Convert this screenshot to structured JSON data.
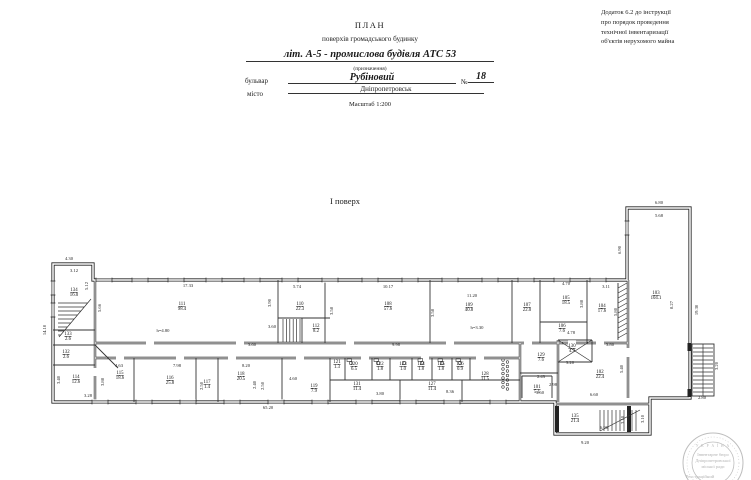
{
  "page": {
    "appendix_note_lines": [
      "Додаток 6.2 до інструкції",
      "про порядок проведення",
      "технічної інвентаризації",
      "об'єктів нерухомого майна"
    ],
    "title": "ПЛАН",
    "subtitle": "поверхів громадського будинку",
    "designation_value": "літ. А-5 - промислова будівля АТС 53",
    "designation_caption": "(призначення)",
    "street_label": "бульвар",
    "street_value": "Рубіновий",
    "number_label": "№",
    "number_value": "18",
    "city_label": "місто",
    "city_value": "Дніпропетровськ",
    "scale_label": "Масштаб 1:200",
    "floor_label": "І поверх"
  },
  "stamp": {
    "arc_text": "У К Р А Ї Н А",
    "lines": [
      "Інвентарне бюро",
      "Дніпропетровської",
      "міської ради"
    ],
    "footer": "Реєстраційний"
  },
  "plan": {
    "rooms": [
      {
        "id": "134",
        "area": "16.0",
        "x": 74,
        "y": 291
      },
      {
        "id": "133",
        "area": "2.6",
        "x": 68,
        "y": 335
      },
      {
        "id": "132",
        "area": "2.6",
        "x": 66,
        "y": 353
      },
      {
        "id": "114",
        "area": "12.6",
        "x": 76,
        "y": 378
      },
      {
        "id": "111",
        "area": "98.4",
        "x": 182,
        "y": 305
      },
      {
        "id": "115",
        "area": "18.6",
        "x": 120,
        "y": 374
      },
      {
        "id": "116",
        "area": "25.8",
        "x": 170,
        "y": 379
      },
      {
        "id": "117",
        "area": "1.4",
        "x": 207,
        "y": 383
      },
      {
        "id": "118",
        "area": "20.5",
        "x": 241,
        "y": 375
      },
      {
        "id": "119",
        "area": "7.9",
        "x": 314,
        "y": 387
      },
      {
        "id": "110",
        "area": "22.3",
        "x": 300,
        "y": 305
      },
      {
        "id": "112",
        "area": "8.2",
        "x": 316,
        "y": 327
      },
      {
        "id": "108",
        "area": "57.6",
        "x": 388,
        "y": 305
      },
      {
        "id": "109",
        "area": "40.8",
        "x": 469,
        "y": 306
      },
      {
        "id": "107",
        "area": "22.0",
        "x": 527,
        "y": 306
      },
      {
        "id": "105",
        "area": "18.5",
        "x": 566,
        "y": 299
      },
      {
        "id": "104",
        "area": "17.6",
        "x": 602,
        "y": 307
      },
      {
        "id": "106",
        "area": "7.6",
        "x": 562,
        "y": 327
      },
      {
        "id": "103",
        "area": "104.1",
        "x": 656,
        "y": 294
      },
      {
        "id": "121",
        "area": "1.3",
        "x": 337,
        "y": 363
      },
      {
        "id": "120",
        "area": "6.5",
        "x": 354,
        "y": 365
      },
      {
        "id": "122",
        "area": "1.8",
        "x": 380,
        "y": 365
      },
      {
        "id": "123",
        "area": "1.0",
        "x": 403,
        "y": 365
      },
      {
        "id": "124",
        "area": "1.8",
        "x": 421,
        "y": 365
      },
      {
        "id": "125",
        "area": "1.8",
        "x": 441,
        "y": 365
      },
      {
        "id": "126",
        "area": "0.9",
        "x": 460,
        "y": 365
      },
      {
        "id": "131",
        "area": "11.4",
        "x": 357,
        "y": 385
      },
      {
        "id": "127",
        "area": "11.4",
        "x": 432,
        "y": 385
      },
      {
        "id": "128",
        "area": "11.5",
        "x": 485,
        "y": 375
      },
      {
        "id": "129",
        "area": "7.6",
        "x": 541,
        "y": 356
      },
      {
        "id": "130",
        "area": "4.9",
        "x": 572,
        "y": 347
      },
      {
        "id": "102",
        "area": "22.4",
        "x": 600,
        "y": 373
      },
      {
        "id": "101",
        "area": "5.1",
        "x": 537,
        "y": 388
      },
      {
        "id": "135",
        "area": "21.4",
        "x": 575,
        "y": 417
      }
    ],
    "dims": [
      {
        "t": "4.30",
        "x": 69,
        "y": 260
      },
      {
        "t": "3.12",
        "x": 74,
        "y": 272
      },
      {
        "t": "5.12",
        "x": 88,
        "y": 286,
        "r": 1
      },
      {
        "t": "14.10",
        "x": 46,
        "y": 330,
        "r": 1
      },
      {
        "t": "5.66",
        "x": 101,
        "y": 308,
        "r": 1
      },
      {
        "t": "17.33",
        "x": 188,
        "y": 287
      },
      {
        "t": "3.90",
        "x": 271,
        "y": 303,
        "r": 1
      },
      {
        "t": "3.60",
        "x": 272,
        "y": 328
      },
      {
        "t": "3.60",
        "x": 252,
        "y": 346
      },
      {
        "t": "h=4.80",
        "x": 163,
        "y": 332
      },
      {
        "t": "5.74",
        "x": 297,
        "y": 288
      },
      {
        "t": "10.17",
        "x": 388,
        "y": 288
      },
      {
        "t": "3.58",
        "x": 333,
        "y": 311,
        "r": 1
      },
      {
        "t": "11.20",
        "x": 472,
        "y": 297
      },
      {
        "t": "3.58",
        "x": 434,
        "y": 313,
        "r": 1
      },
      {
        "t": "h=3.30",
        "x": 477,
        "y": 329
      },
      {
        "t": "4.70",
        "x": 566,
        "y": 285
      },
      {
        "t": "3.11",
        "x": 606,
        "y": 288
      },
      {
        "t": "3.88",
        "x": 583,
        "y": 304,
        "r": 1
      },
      {
        "t": "5.80",
        "x": 617,
        "y": 312,
        "r": 1
      },
      {
        "t": "4.78",
        "x": 571,
        "y": 334
      },
      {
        "t": "6.80",
        "x": 659,
        "y": 204
      },
      {
        "t": "5.68",
        "x": 659,
        "y": 217
      },
      {
        "t": "6.90",
        "x": 621,
        "y": 250,
        "r": 1
      },
      {
        "t": "19.30",
        "x": 698,
        "y": 310,
        "r": 1
      },
      {
        "t": "8.27",
        "x": 673,
        "y": 305,
        "r": 1
      },
      {
        "t": "9.98",
        "x": 396,
        "y": 346
      },
      {
        "t": "4.63",
        "x": 119,
        "y": 367
      },
      {
        "t": "7.98",
        "x": 177,
        "y": 367
      },
      {
        "t": "2.50",
        "x": 203,
        "y": 386,
        "r": 1
      },
      {
        "t": "8.20",
        "x": 246,
        "y": 367
      },
      {
        "t": "2.40",
        "x": 256,
        "y": 385,
        "r": 1
      },
      {
        "t": "2.50",
        "x": 264,
        "y": 386,
        "r": 1
      },
      {
        "t": "4.60",
        "x": 293,
        "y": 380
      },
      {
        "t": "3.88",
        "x": 104,
        "y": 382,
        "r": 1
      },
      {
        "t": "3.40",
        "x": 60,
        "y": 380,
        "r": 1
      },
      {
        "t": "3.28",
        "x": 88,
        "y": 397
      },
      {
        "t": "65.20",
        "x": 268,
        "y": 409
      },
      {
        "t": "3.80",
        "x": 380,
        "y": 395
      },
      {
        "t": "8.36",
        "x": 450,
        "y": 393
      },
      {
        "t": "3.60",
        "x": 540,
        "y": 394
      },
      {
        "t": "3.80",
        "x": 610,
        "y": 346
      },
      {
        "t": "2.43",
        "x": 541,
        "y": 378
      },
      {
        "t": "2.98",
        "x": 553,
        "y": 386
      },
      {
        "t": "3.20",
        "x": 570,
        "y": 364
      },
      {
        "t": "5.40",
        "x": 623,
        "y": 369,
        "r": 1
      },
      {
        "t": "6.60",
        "x": 594,
        "y": 396
      },
      {
        "t": "2.80",
        "x": 702,
        "y": 399
      },
      {
        "t": "3.20",
        "x": 718,
        "y": 366,
        "r": 1
      },
      {
        "t": "9.20",
        "x": 585,
        "y": 444
      },
      {
        "t": "6.90",
        "x": 604,
        "y": 429
      },
      {
        "t": "3.10",
        "x": 624,
        "y": 420,
        "r": 1
      },
      {
        "t": "3.10",
        "x": 644,
        "y": 419,
        "r": 1
      }
    ]
  }
}
